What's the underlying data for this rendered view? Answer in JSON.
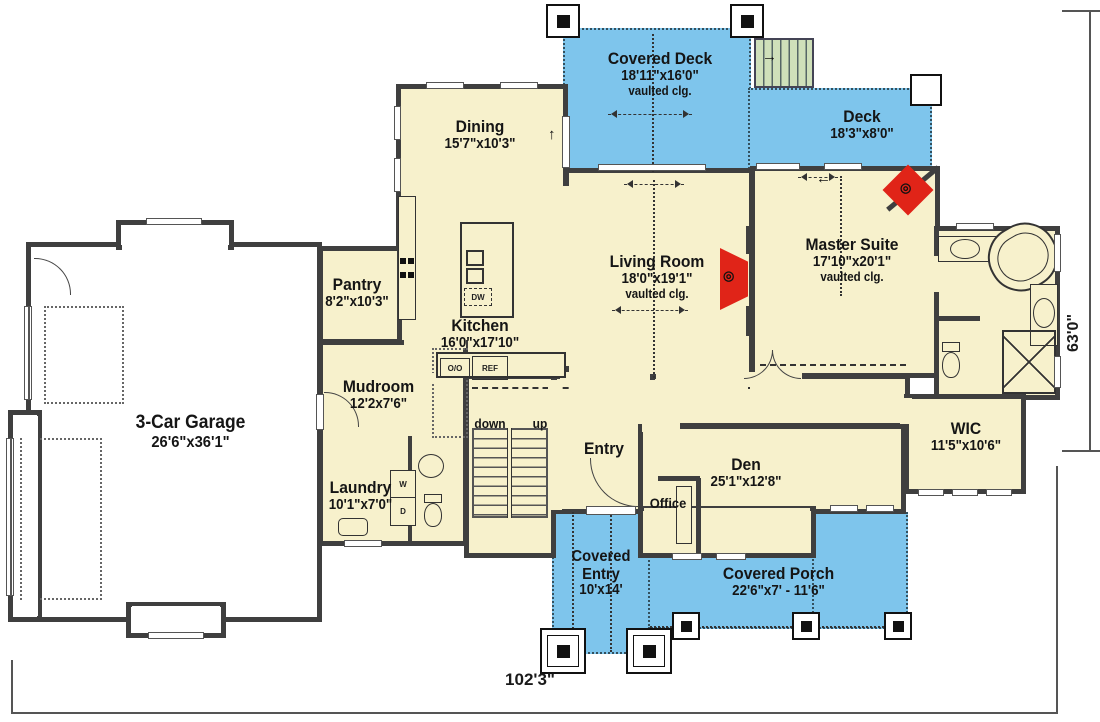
{
  "plan": {
    "colors": {
      "room_fill": "#f7f1cc",
      "outdoor_fill": "#7ec5ec",
      "wall": "#3f3f3f",
      "garage_fill": "#ffffff",
      "fireplace_red": "#e02418",
      "stair_tread_green": "#cfe0ba"
    },
    "rooms": {
      "covered_deck": {
        "name": "Covered Deck",
        "dims": "18'11\"x16'0\"",
        "note": "vaulted clg."
      },
      "deck": {
        "name": "Deck",
        "dims": "18'3\"x8'0\""
      },
      "dining": {
        "name": "Dining",
        "dims": "15'7\"x10'3\""
      },
      "living_room": {
        "name": "Living Room",
        "dims": "18'0\"x19'1\"",
        "note": "vaulted clg."
      },
      "master_suite": {
        "name": "Master Suite",
        "dims": "17'10\"x20'1\"",
        "note": "vaulted clg."
      },
      "pantry": {
        "name": "Pantry",
        "dims": "8'2\"x10'3\""
      },
      "kitchen": {
        "name": "Kitchen",
        "dims": "16'0\"x17'10\""
      },
      "mudroom": {
        "name": "Mudroom",
        "dims": "12'2x7'6\""
      },
      "garage": {
        "name": "3-Car Garage",
        "dims": "26'6\"x36'1\""
      },
      "laundry": {
        "name": "Laundry",
        "dims": "10'1\"x7'0\""
      },
      "entry": {
        "name": "Entry"
      },
      "office": {
        "name": "Office"
      },
      "den": {
        "name": "Den",
        "dims": "25'1\"x12'8\""
      },
      "wic": {
        "name": "WIC",
        "dims": "11'5\"x10'6\""
      },
      "covered_entry": {
        "name": "Covered Entry",
        "dims": "10'x14'"
      },
      "covered_porch": {
        "name": "Covered Porch",
        "dims": "22'6\"x7' - 11'6\""
      }
    },
    "stairs": {
      "down_label": "down",
      "up_label": "up"
    },
    "appliances": {
      "double_oven": "O/O",
      "refrigerator": "REF",
      "dishwasher": "DW",
      "washer": "W",
      "dryer": "D"
    },
    "overall_dimensions": {
      "width": "102'3\"",
      "depth": "63'0\""
    },
    "icons": {
      "up_arrow": "↑",
      "right_arrow": "→",
      "left_arrow": "←",
      "fireplace": "◎"
    }
  }
}
